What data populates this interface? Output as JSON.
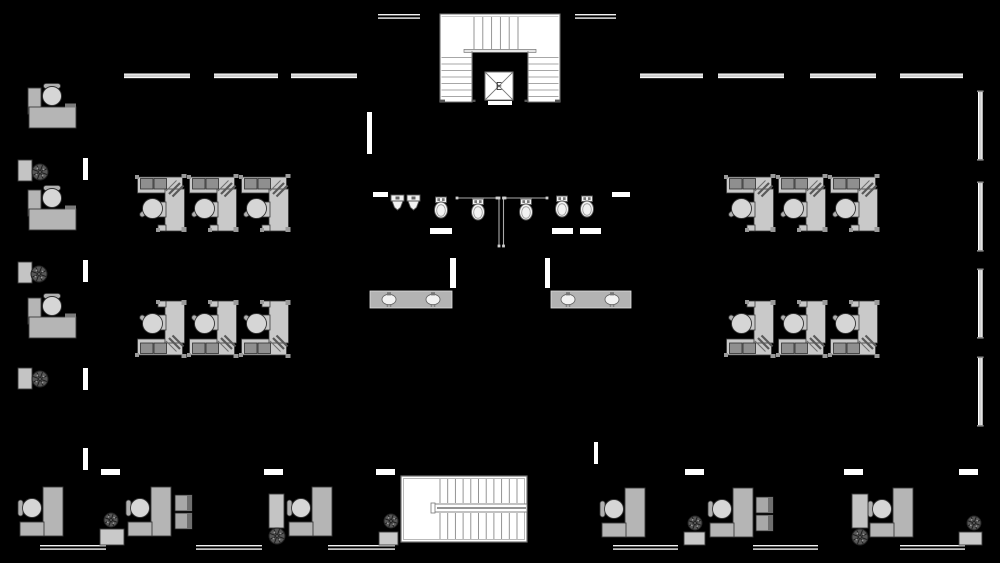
{
  "meta": {
    "type": "architectural-floor-plan",
    "visible_text_labels": [
      "E"
    ]
  },
  "canvas": {
    "w": 1000,
    "h": 563,
    "background": "#000000"
  },
  "colors": {
    "background": "#000000",
    "wall_white": "#f2f2f2",
    "window_fill": "#cfcfcf",
    "opening": "#ffffff",
    "panel": "#c9c9c9",
    "panel_mid": "#b5b5b5",
    "panel_dark": "#8f8f8f",
    "outline": "#3a3a3a",
    "chair": "#d6d6d6",
    "stair_fill": "#ffffff",
    "stair_line": "#8a8a8a",
    "stair_border": "#707070",
    "fixture": "#f2f2f2",
    "fixture_stroke": "#555555",
    "partition": "#aaaaaa",
    "plant_fill": "#565656",
    "plant_stroke": "#222222",
    "label": "#333333"
  },
  "walls": {
    "window_top_y": 73.5,
    "window_top": [
      [
        124,
        66
      ],
      [
        214,
        64
      ],
      [
        291,
        66
      ],
      [
        640,
        63
      ],
      [
        718,
        66
      ],
      [
        810,
        66
      ],
      [
        900,
        63
      ]
    ],
    "window_right_x": 978,
    "window_right": [
      [
        92,
        67
      ],
      [
        183,
        67
      ],
      [
        270,
        67
      ],
      [
        358,
        67
      ]
    ],
    "double_top_y": 14,
    "double_top": [
      [
        378,
        42
      ],
      [
        575,
        41
      ]
    ],
    "double_bottom_y": 545,
    "double_bottom": [
      [
        40,
        66
      ],
      [
        196,
        66
      ],
      [
        328,
        67
      ],
      [
        613,
        65
      ],
      [
        753,
        65
      ],
      [
        900,
        65
      ]
    ],
    "openings": [
      [
        83,
        158,
        5,
        22
      ],
      [
        83,
        260,
        5,
        22
      ],
      [
        83,
        368,
        5,
        22
      ],
      [
        83,
        448,
        5,
        22
      ],
      [
        367,
        112,
        5,
        42
      ],
      [
        450,
        258,
        6,
        30
      ],
      [
        545,
        258,
        5,
        30
      ],
      [
        594,
        442,
        4,
        22
      ],
      [
        101,
        469,
        19,
        6
      ],
      [
        264,
        469,
        19,
        6
      ],
      [
        376,
        469,
        19,
        6
      ],
      [
        685,
        469,
        19,
        6
      ],
      [
        844,
        469,
        19,
        6
      ],
      [
        959,
        469,
        19,
        6
      ],
      [
        373,
        192,
        15,
        5
      ],
      [
        612,
        192,
        18,
        5
      ],
      [
        430,
        228,
        22,
        6
      ],
      [
        552,
        228,
        21,
        6
      ],
      [
        580,
        228,
        21,
        6
      ],
      [
        488,
        101,
        24,
        4
      ]
    ]
  },
  "restroom": {
    "toilets": [
      [
        441,
        197
      ],
      [
        478,
        199
      ],
      [
        526,
        199
      ],
      [
        562,
        196
      ],
      [
        587,
        196
      ]
    ],
    "urinals": [
      [
        391,
        195
      ],
      [
        407,
        195
      ]
    ],
    "partitions_h": [
      [
        457,
        497,
        198
      ],
      [
        505,
        547,
        198
      ]
    ],
    "partitions_v": [
      [
        499,
        198,
        246
      ],
      [
        503.5,
        198,
        246
      ]
    ],
    "sink_counters": [
      {
        "x": 370,
        "y": 291,
        "w": 82,
        "h": 17,
        "sinks": [
          389,
          433
        ]
      },
      {
        "x": 551,
        "y": 291,
        "w": 80,
        "h": 17,
        "sinks": [
          568,
          612
        ]
      }
    ]
  },
  "stairs": {
    "top": {
      "x": 440,
      "y": 14,
      "w": 120,
      "h": 88,
      "void_x": 472,
      "void_w": 56,
      "landing_y": 51,
      "elevator": {
        "x": 485,
        "y": 72,
        "size": 28,
        "label": "E"
      }
    },
    "bottom": {
      "x": 401,
      "y": 476,
      "w": 126,
      "h": 66,
      "landing_w": 37,
      "rail_y": 504,
      "rail_h": 8
    }
  },
  "furniture": {
    "cubicle_rows": [
      {
        "x": 136,
        "y": 175,
        "count": 3,
        "pitch": 52,
        "flip": false
      },
      {
        "x": 136,
        "y": 299,
        "count": 3,
        "pitch": 52,
        "flip": true
      },
      {
        "x": 725,
        "y": 175,
        "count": 3,
        "pitch": 52,
        "flip": false
      },
      {
        "x": 725,
        "y": 299,
        "count": 3,
        "pitch": 52,
        "flip": true
      }
    ],
    "reception_desks": [
      [
        28,
        86
      ],
      [
        28,
        188
      ],
      [
        28,
        296
      ]
    ],
    "side_cabinets": [
      [
        18,
        160
      ],
      [
        18,
        262
      ],
      [
        18,
        368
      ]
    ],
    "tall_cabinets": [
      [
        269,
        494,
        15,
        34
      ],
      [
        852,
        494,
        16,
        34
      ]
    ],
    "bottom_desks": [
      [
        20,
        486
      ],
      [
        128,
        486
      ],
      [
        289,
        486
      ],
      [
        602,
        487
      ],
      [
        710,
        487
      ],
      [
        870,
        487
      ]
    ],
    "file_cabinets": [
      [
        175,
        495
      ],
      [
        756,
        497
      ]
    ],
    "tables": [
      [
        100,
        529,
        24,
        16
      ],
      [
        379,
        532,
        19,
        13
      ],
      [
        684,
        532,
        21,
        13
      ],
      [
        959,
        532,
        23,
        13
      ]
    ],
    "plants": [
      [
        40,
        172,
        8
      ],
      [
        39,
        274,
        8
      ],
      [
        40,
        379,
        8
      ],
      [
        111,
        520,
        7
      ],
      [
        277,
        536,
        8
      ],
      [
        391,
        521,
        7
      ],
      [
        695,
        523,
        7
      ],
      [
        860,
        537,
        8
      ],
      [
        974,
        523,
        7
      ]
    ]
  }
}
